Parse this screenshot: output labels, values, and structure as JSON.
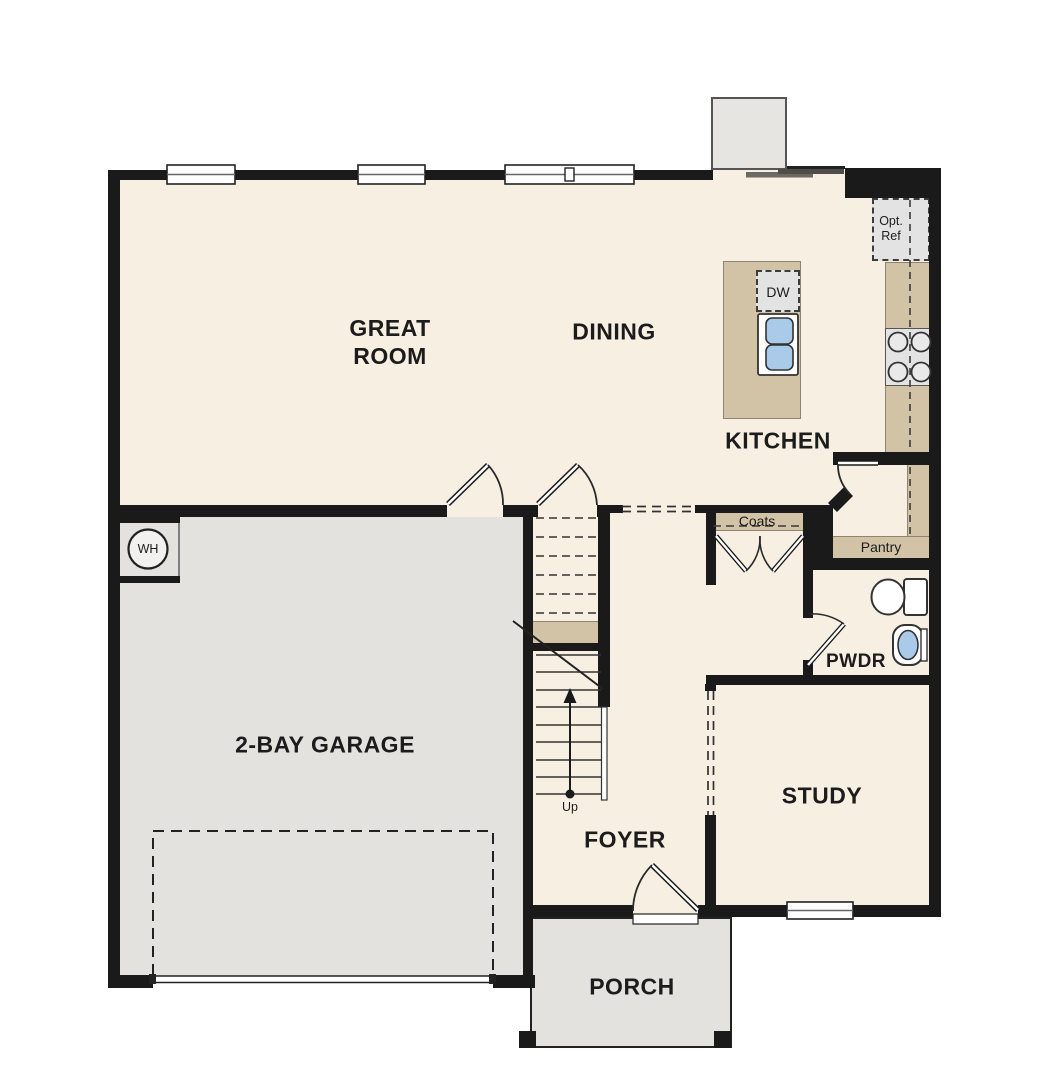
{
  "title": "First Floor Plan",
  "labels": {
    "great_room_1": "GREAT",
    "great_room_2": "ROOM",
    "dining": "DINING",
    "kitchen": "KITCHEN",
    "garage": "2-BAY GARAGE",
    "foyer": "FOYER",
    "study": "STUDY",
    "porch": "PORCH",
    "powder": "PWDR",
    "coats": "Coats",
    "pantry": "Pantry",
    "opt_ref_1": "Opt.",
    "opt_ref_2": "Ref",
    "dishwasher": "DW",
    "water_heater": "WH",
    "stairs_up": "Up"
  },
  "colors": {
    "wall": "#1a1a1a",
    "floor": "#f6efe2",
    "garage": "#e4e2df",
    "tan": "#d2c3a6",
    "appliance": "#e3e3e3",
    "sink_blue": "#a9cbe9",
    "outline": "#3a3a3a",
    "text": "#1c1c1c"
  }
}
